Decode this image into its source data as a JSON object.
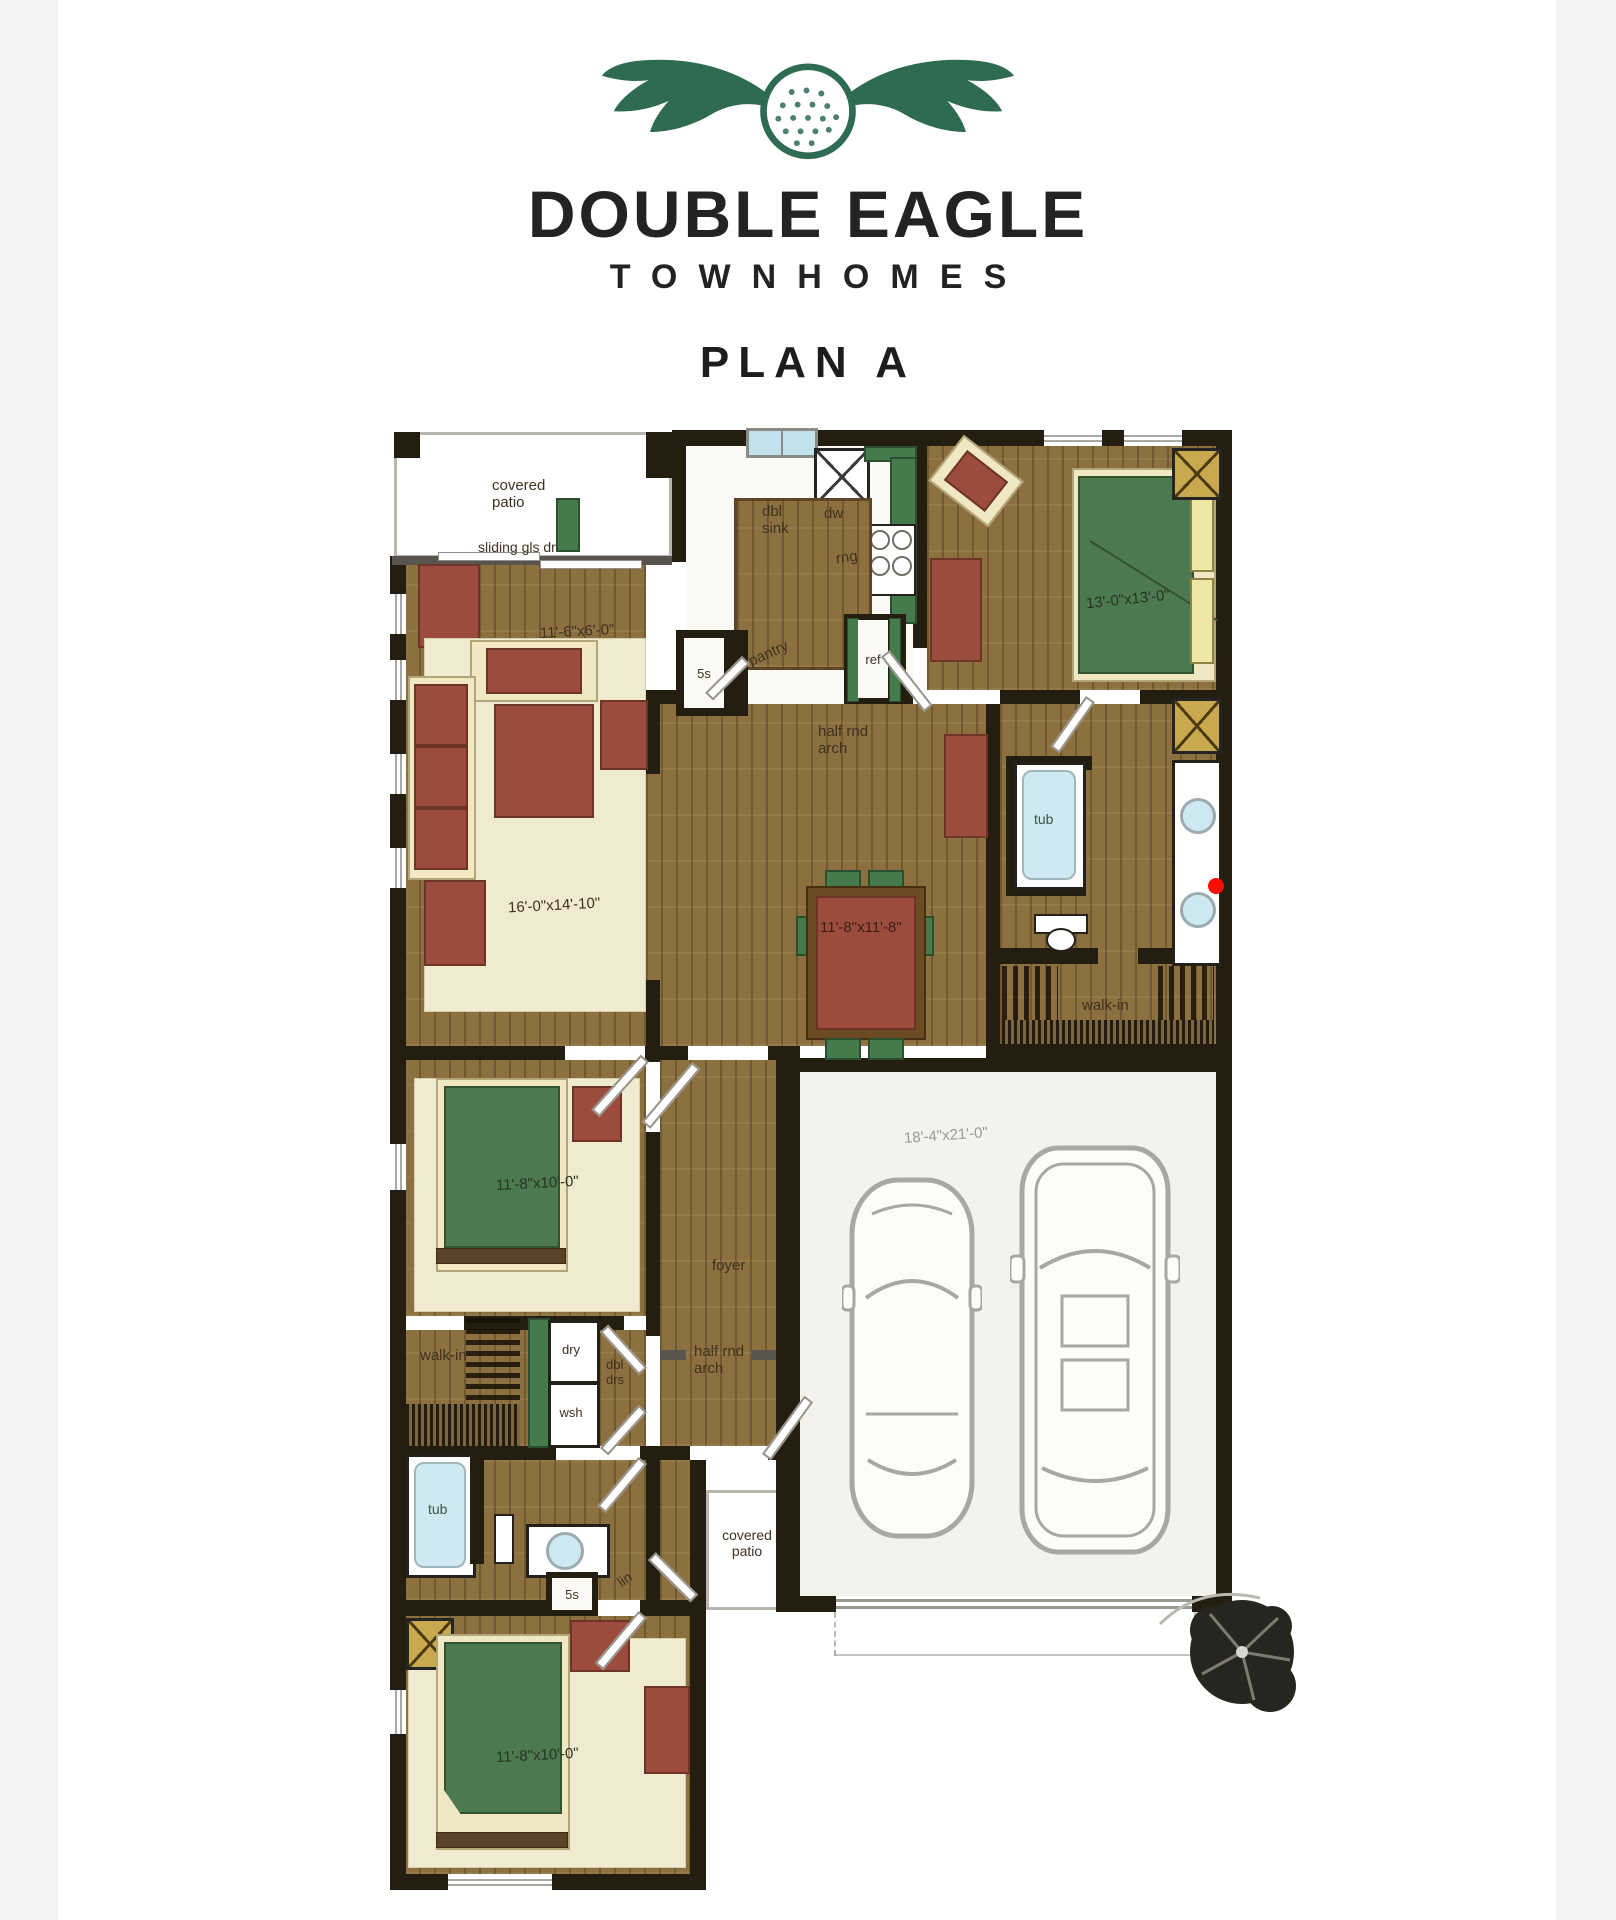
{
  "header": {
    "logo_icon": "winged-golf-ball-logo",
    "logo_color": "#2e6b51",
    "brand_name": "DOUBLE EAGLE",
    "brand_subtitle": "TOWNHOMES",
    "plan_title": "PLAN A"
  },
  "palette": {
    "wall": "#241e11",
    "wood_floor": "#8d7040",
    "rug_cream": "#f0ead0",
    "bed_green": "#4d7950",
    "counter_green": "#457a4c",
    "furniture_red": "#9b4c3c",
    "water_blue": "#cfe9f0",
    "pillow_yellow": "#efe7a4",
    "nightstand_gold": "#c9a94f",
    "garage_floor": "#f3f2ec",
    "marker_red": "#fb0d00",
    "logo_green": "#2e6b51"
  },
  "rooms": {
    "patio_top": {
      "line1": "covered",
      "line2": "patio"
    },
    "sliding_door": "sliding gls dr",
    "nook": {
      "dim": "11'-6\"x6'-0\""
    },
    "kitchen": {
      "sink_line1": "dbl",
      "sink_line2": "sink",
      "dishwasher": "dw",
      "range": "rng",
      "pantry": "pantry",
      "shelves": "5s",
      "fridge": "ref"
    },
    "arch_kitchen": {
      "line1": "half rnd",
      "line2": "arch"
    },
    "master": {
      "dim": "13'-0\"x13'-0\""
    },
    "master_bath": {
      "tub": "tub"
    },
    "master_closet": "walk-in",
    "living": {
      "dim": "16'-0\"x14'-10\""
    },
    "dining": {
      "dim": "11'-8\"x11'-8\""
    },
    "garage": {
      "dim": "18'-4\"x21'-0\""
    },
    "bed2": {
      "dim": "11'-8\"x10'-0\""
    },
    "foyer": "foyer",
    "arch_foyer": {
      "line1": "half rnd",
      "line2": "arch"
    },
    "closet2": "walk-in",
    "laundry": {
      "dryer": "dry",
      "washer": "wsh",
      "doors_line1": "dbl",
      "doors_line2": "drs"
    },
    "bath2": {
      "tub": "tub",
      "linen": "lin",
      "shelves": "5s"
    },
    "patio_bottom": {
      "line1": "covered",
      "line2": "patio"
    },
    "bed3": {
      "dim": "11'-8\"x10'-0\""
    }
  }
}
